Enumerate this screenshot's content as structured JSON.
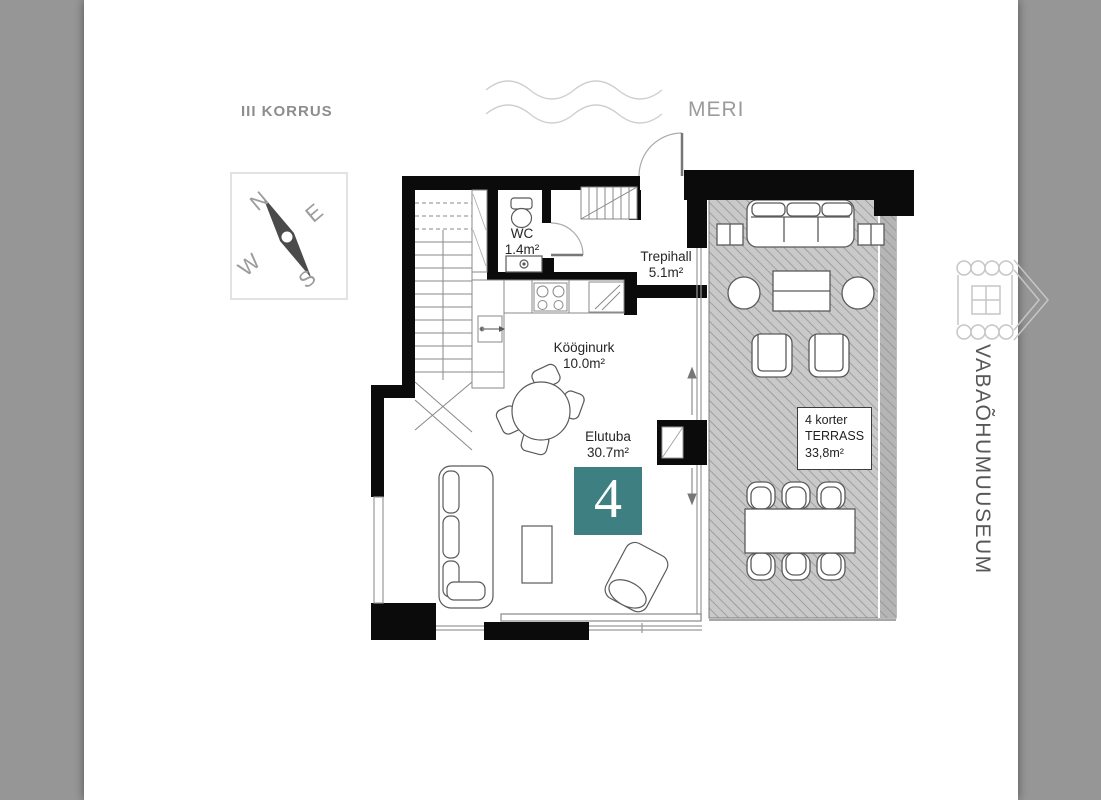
{
  "header": {
    "floor_label": "III KORRUS"
  },
  "environment": {
    "sea_label": "MERI",
    "museum_label": "VABAÕHUMUUSEUM"
  },
  "compass": {
    "n": "N",
    "e": "E",
    "s": "S",
    "w": "W"
  },
  "rooms": {
    "wc": {
      "name": "WC",
      "area": "1.4m²"
    },
    "trepihall": {
      "name": "Trepihall",
      "area": "5.1m²"
    },
    "kooginurk": {
      "name": "Kööginurk",
      "area": "10.0m²"
    },
    "elutuba": {
      "name": "Elutuba",
      "area": "30.7m²"
    }
  },
  "terrace_label": {
    "unit": "4 korter",
    "name": "TERRASS",
    "area": "33,8m²"
  },
  "unit_marker": {
    "number": "4",
    "accent_color": "#3e7f82"
  }
}
